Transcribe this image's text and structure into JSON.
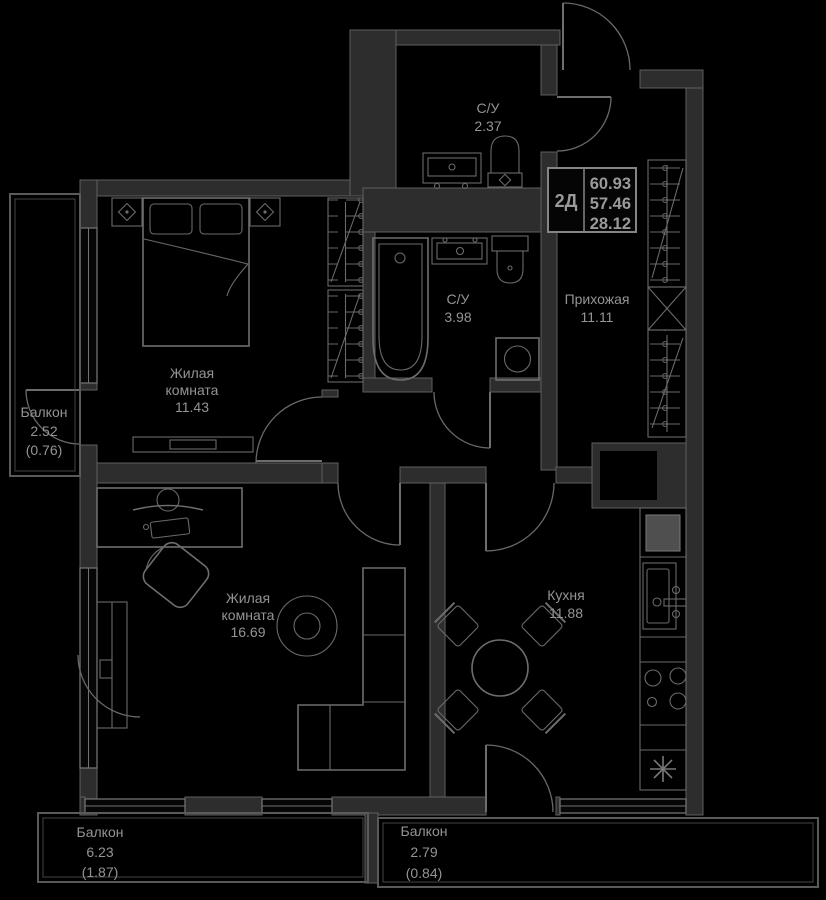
{
  "legend": {
    "type": "2Д",
    "total_area": "60.93",
    "area_without_balconies": "57.46",
    "living_area": "28.12"
  },
  "rooms": {
    "bedroom": {
      "line1": "Жилая",
      "line2": "комната",
      "area": "11.43"
    },
    "living_room": {
      "line1": "Жилая",
      "line2": "комната",
      "area": "16.69"
    },
    "kitchen": {
      "name": "Кухня",
      "area": "11.88"
    },
    "hallway": {
      "name": "Прихожая",
      "area": "11.11"
    },
    "bathroom_guest": {
      "name": "С/У",
      "area": "2.37"
    },
    "bathroom_main": {
      "name": "С/У",
      "area": "3.98"
    },
    "balcony_west": {
      "name": "Балкон",
      "area": "2.52",
      "area_reduced": "(0.76)"
    },
    "balcony_south_west": {
      "name": "Балкон",
      "area": "6.23",
      "area_reduced": "(1.87)"
    },
    "balcony_south": {
      "name": "Балкон",
      "area": "2.79",
      "area_reduced": "(0.84)"
    }
  },
  "colors": {
    "background": "#000000",
    "wall_fill": "#2d2d2d",
    "wall_stroke": "#5e5e5e",
    "furniture_line": "#6e6e6e",
    "text": "#949494"
  }
}
